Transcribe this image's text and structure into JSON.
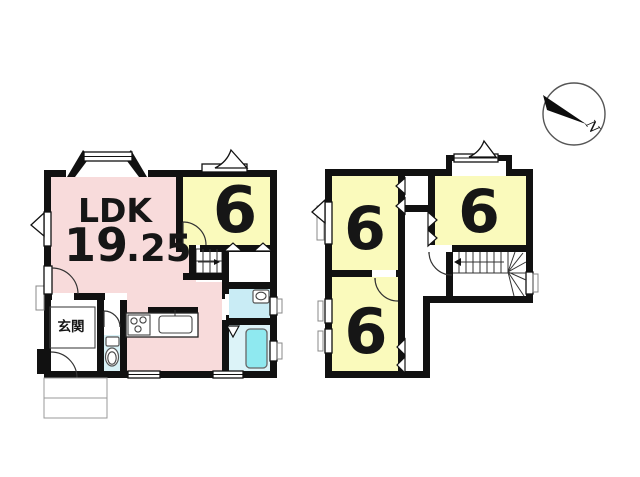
{
  "compass": {
    "north_label": "N"
  },
  "floor1": {
    "ldk": {
      "label": "LDK",
      "area_major": "19",
      "area_minor": ".25"
    },
    "room": {
      "label": "6"
    },
    "entrance": {
      "label": "玄関"
    }
  },
  "floor2": {
    "rooms": [
      {
        "label": "6"
      },
      {
        "label": "6"
      },
      {
        "label": "6"
      }
    ]
  },
  "colors": {
    "wall": "#111111",
    "ldk": "#f8dbdb",
    "tatami_room": "#fafabc",
    "washroom": "#c9ecf5",
    "bath_floor": "#dcf3f8",
    "bathtub": "#8fe9f0",
    "toilet_floor": "#d8f1f6"
  }
}
